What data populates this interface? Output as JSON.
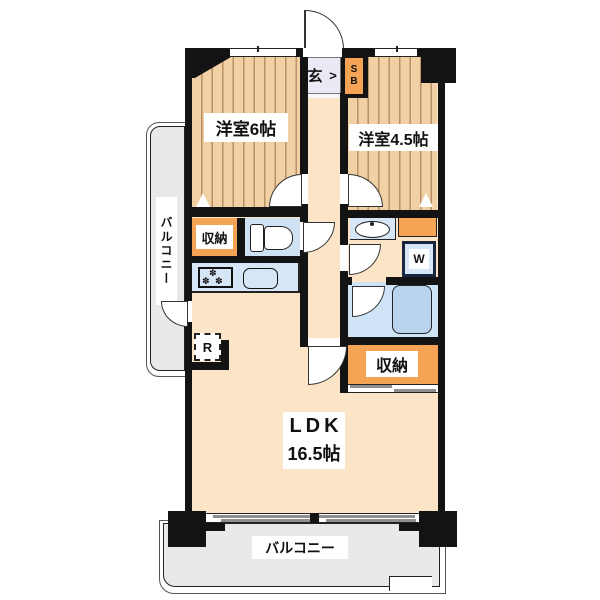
{
  "plan_type": "apartment-floor-plan",
  "labels": {
    "bedroom1": "洋室6帖",
    "bedroom2": "洋室4.5帖",
    "ldk_name": "LDK",
    "ldk_size": "16.5帖",
    "closet_left": "収納",
    "closet_right": "収納",
    "entrance": "玄",
    "entrance_step_mark": ">",
    "shoe_box": "SB",
    "washing_machine": "W",
    "refrigerator": "R",
    "balcony_left": "バルコニー",
    "balcony_bottom": "バルコニー"
  },
  "icons": {
    "stove_burner_glyph": "✽"
  },
  "colors": {
    "wall": "#131313",
    "floor_beige": "#fce4c6",
    "wood_stripe": "#f2d0a5",
    "wood_stripe_line": "#bb9065",
    "closet_orange": "#f5a456",
    "fixture_blue": "#d6e6f7",
    "bathroom_blue": "#cfe3f7",
    "bathtub_blue": "#b9d3ee",
    "toilet_room_blue": "#cfe2f4",
    "balcony_gray": "#e9e9e9",
    "entrance_tile": "#eaeaf4"
  }
}
